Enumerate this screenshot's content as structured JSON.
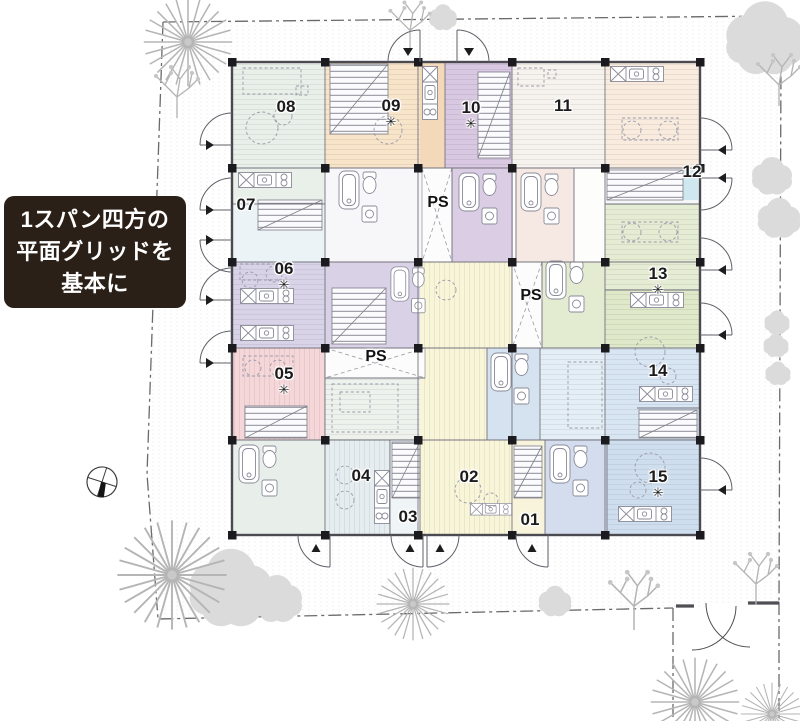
{
  "callout": {
    "line1": "1スパン四方の",
    "line2": "平面グリッドを",
    "line3": "基本に",
    "bg_color": "#2b2018",
    "text_color": "#ffffff"
  },
  "units": [
    {
      "id": "01",
      "star": "",
      "color": "#f8f4dc"
    },
    {
      "id": "02",
      "star": "",
      "color": "#f9f5d9"
    },
    {
      "id": "03",
      "star": "",
      "color": "#eff4f6"
    },
    {
      "id": "04",
      "star": "",
      "color": "#e5edf0"
    },
    {
      "id": "05",
      "star": "✳",
      "color": "#f6d7d9"
    },
    {
      "id": "06",
      "star": "✳",
      "color": "#d9d3e8"
    },
    {
      "id": "07",
      "star": "",
      "color": "#ebf3f6"
    },
    {
      "id": "08",
      "star": "",
      "color": "#e9efe9"
    },
    {
      "id": "09",
      "star": "✳",
      "color": "#f7e4c9"
    },
    {
      "id": "10",
      "star": "✳",
      "color": "#d9c8e1"
    },
    {
      "id": "11",
      "star": "",
      "color": "#f6f2ee"
    },
    {
      "id": "12",
      "star": "",
      "color": "#f5f6f7"
    },
    {
      "id": "13",
      "star": "✳",
      "color": "#dfe8c9"
    },
    {
      "id": "14",
      "star": "",
      "color": "#d8e5f2"
    },
    {
      "id": "15",
      "star": "✳",
      "color": "#cfdeef"
    }
  ],
  "ps_labels": [
    "PS",
    "PS",
    "PS"
  ],
  "palette": {
    "wall": "#4a4a50",
    "column": "#1b1b1f",
    "site_boundary": "#6a6a6a",
    "tree_fill": "#dbdbdb",
    "tree_stroke": "#b5b5b5",
    "gravel_dot": "#d9d9d9"
  }
}
